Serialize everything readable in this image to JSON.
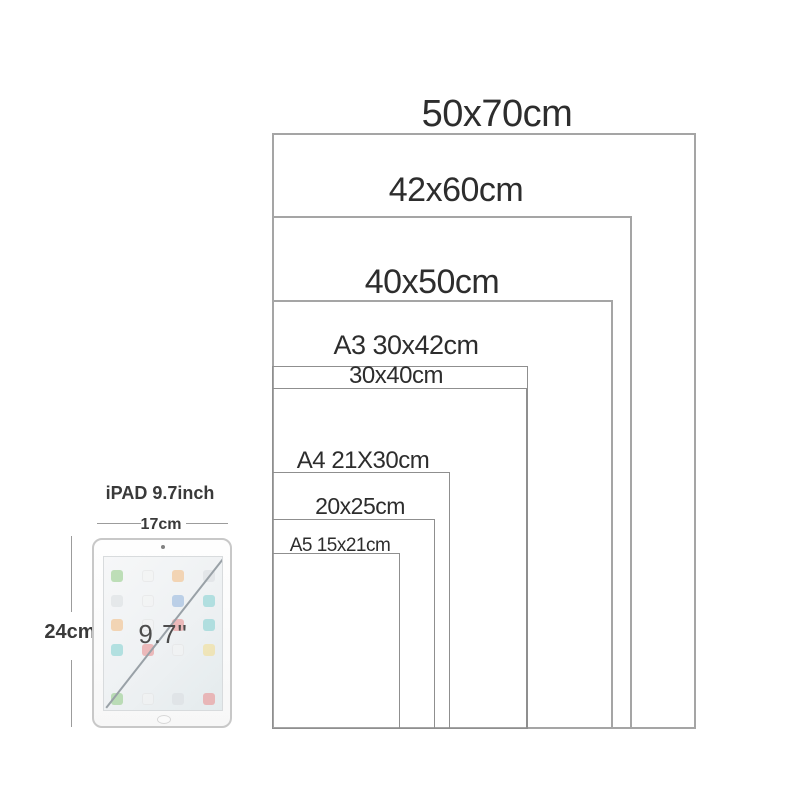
{
  "diagram": {
    "description": "poster frame size comparison",
    "sizes": [
      {
        "label": "50x70cm"
      },
      {
        "label": "42x60cm"
      },
      {
        "label": "40x50cm"
      },
      {
        "label": "A3 30x42cm"
      },
      {
        "label": "30x40cm"
      },
      {
        "label": "A4 21X30cm"
      },
      {
        "label": "20x25cm"
      },
      {
        "label": "A5 15x21cm"
      }
    ]
  },
  "ipad": {
    "title": "iPAD 9.7inch",
    "width_label": "17cm",
    "height_label": "24cm",
    "screen_diagonal": "9.7\""
  },
  "colors": {
    "background": "#ffffff",
    "frame_border_outer": "#a5a5a5",
    "frame_border_inner": "#8f8f8f",
    "size_label_text": "#2d2d2d",
    "ipad_label_text": "#3a3a3a",
    "ipad_body_border": "#c8c8c8"
  }
}
